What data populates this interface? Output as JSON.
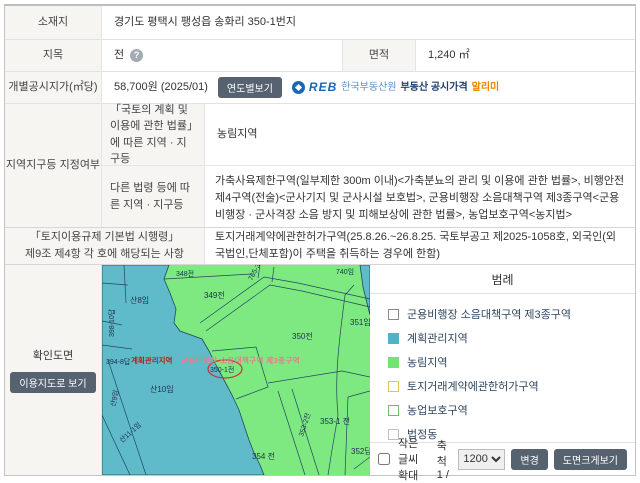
{
  "table": {
    "location": {
      "label": "소재지",
      "value": "경기도 평택시 팽성읍 송화리 350-1번지"
    },
    "category": {
      "label": "지목",
      "value": "전",
      "help_icon": "?"
    },
    "area": {
      "label": "면적",
      "value": "1,240 ㎡"
    },
    "price": {
      "label": "개별공시지가(㎡당)",
      "value": "58,700원 (2025/01)",
      "button": "연도별보기",
      "logo": {
        "name": "REB",
        "org": "한국부동산원",
        "service": "부동산 공시가격",
        "suffix": "알리미"
      }
    },
    "zoning": {
      "label": "지역지구등 지정여부",
      "national_law": {
        "label": "「국토의 계획 및 이용에 관한 법률」에 따른 지역 · 지구등",
        "value": "농림지역"
      },
      "other_laws": {
        "label": "다른 법령 등에 따른 지역 · 지구등",
        "value": "가축사육제한구역(일부제한 300m 이내)<가축분뇨의 관리 및 이용에 관한 법률>, 비행안전제4구역(전술)<군사기지 및 군사시설 보호법>, 군용비행장 소음대책구역 제3종구역<군용비행장 · 군사격장 소음 방지 및 피해보상에 관한 법률>, 농업보호구역<농지법>"
      }
    },
    "regulation": {
      "label_line1": "「토지이용규제 기본법 시행령」",
      "label_line2": "제9조 제4항 각 호에 해당되는 사항",
      "value": "토지거래계약에관한허가구역(25.8.26.~26.8.25. 국토부공고 제2025-1058호, 외국인(외국법인,단체포함)이 주택을 취득하는 경우에 한함)"
    },
    "drawing": {
      "label": "확인도면",
      "button": "이용지도로 보기"
    }
  },
  "map": {
    "colors": {
      "farmland_green": "#7de980",
      "management_teal": "#5fbbc9",
      "parcel_line": "#23455e",
      "highlight_red": "#cc3333"
    },
    "labels": [
      {
        "text": "348전"
      },
      {
        "text": "349전"
      },
      {
        "text": "740임"
      },
      {
        "text": "765-3"
      },
      {
        "text": "산8임"
      },
      {
        "text": "398-10답"
      },
      {
        "text": "394-8답"
      },
      {
        "text": "산9임"
      },
      {
        "text": "산10임"
      },
      {
        "text": "산11-1임"
      },
      {
        "text": "350전"
      },
      {
        "text": "351임"
      },
      {
        "text": "350-1전"
      },
      {
        "text": "354 전"
      },
      {
        "text": "353-2전"
      },
      {
        "text": "353-1 전"
      },
      {
        "text": "352답"
      },
      {
        "text": "계획관리지역"
      },
      {
        "text": "군용비행장 소음대책구역 제3종구역"
      }
    ]
  },
  "legend": {
    "title": "범례",
    "items": [
      {
        "label": "군용비행장 소음대책구역 제3종구역",
        "fill": "#ffffff",
        "border": "#8a8a8a"
      },
      {
        "label": "계획관리지역",
        "fill": "#4fb3c6",
        "border": "#4fb3c6"
      },
      {
        "label": "농림지역",
        "fill": "#72e472",
        "border": "#72e472"
      },
      {
        "label": "토지거래계약에관한허가구역",
        "fill": "#ffffff",
        "border": "#dfc64d"
      },
      {
        "label": "농업보호구역",
        "fill": "#ffffff",
        "border": "#6cbf6c"
      },
      {
        "label": "법정동",
        "fill": "#ffffff",
        "border": "#c0c0c0"
      }
    ]
  },
  "controls": {
    "zoom_text_label": "작은글씨확대",
    "scale_label": "축척 1 /",
    "scale_value": "1200",
    "change_button": "변경",
    "enlarge_button": "도면크게보기"
  }
}
